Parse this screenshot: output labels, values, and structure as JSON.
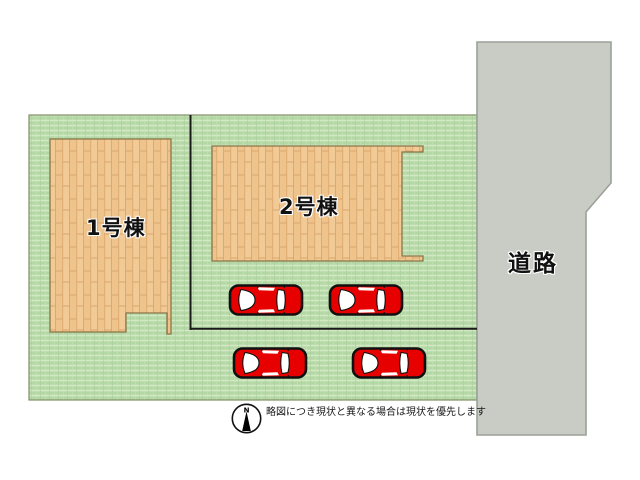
{
  "labels": {
    "building1": "1号棟",
    "building2": "2号棟",
    "road": "道路",
    "compass_north": "N",
    "disclaimer": "略図につき現状と異なる場合は現状を優先します"
  },
  "cars": [
    {
      "transform": "translate(228,281)"
    },
    {
      "transform": "translate(328,281)"
    },
    {
      "transform": "translate(232,344)"
    },
    {
      "transform": "translate(351,344)"
    }
  ],
  "colors": {
    "grass": "#bcdcae",
    "wood": "#f2ca96",
    "road": "#c9ccc4",
    "car_body": "#e60000",
    "outline": "#1a1a1a",
    "building_border": "#8a7648",
    "field_border": "#7f8f66"
  }
}
